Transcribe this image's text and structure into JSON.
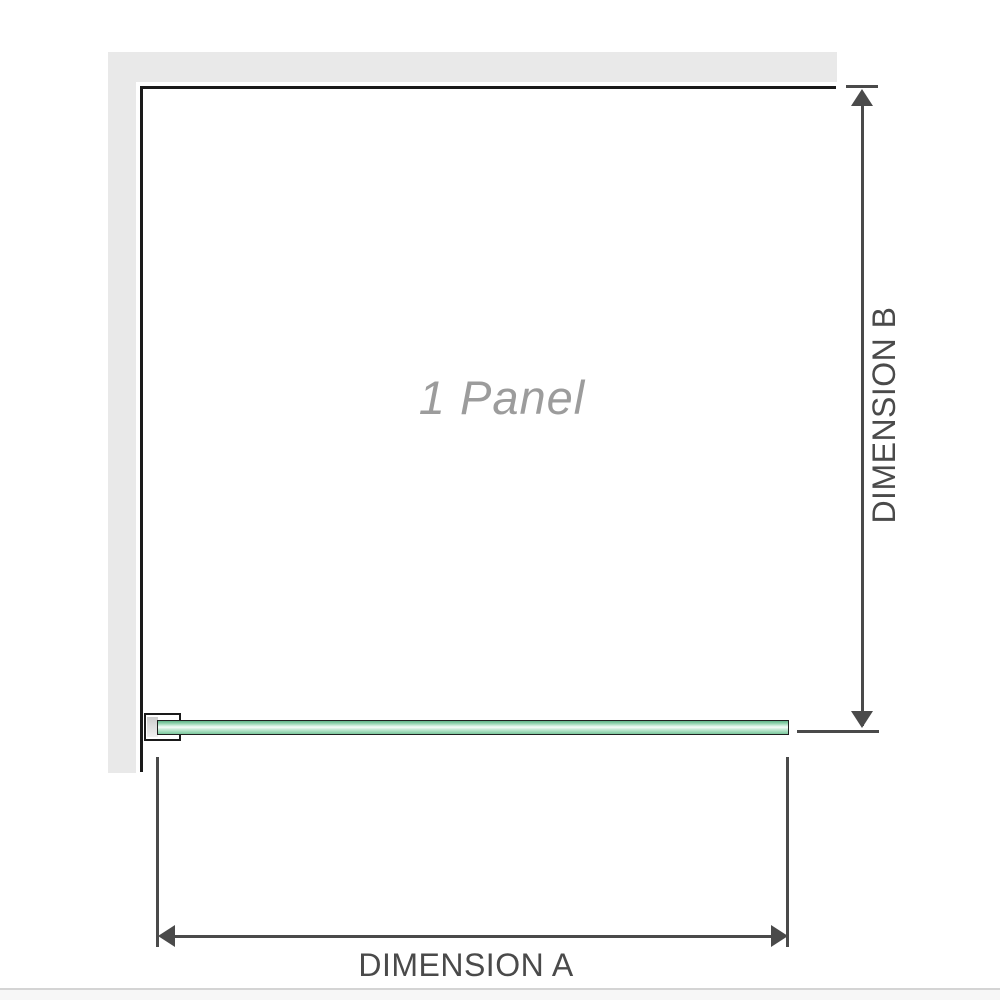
{
  "diagram": {
    "panel_label": "1 Panel",
    "dimension_a": {
      "label": "DIMENSION A",
      "orientation": "horizontal"
    },
    "dimension_b": {
      "label": "DIMENSION B",
      "orientation": "vertical"
    }
  },
  "colors": {
    "wall_gray": "#e9e9e9",
    "outline_black": "#1a1a1a",
    "dim_gray": "#4a4a4a",
    "label_gray": "#9c9c9c",
    "glass_border": "#1f1f1f",
    "glass_green_light": "#ddf3e7",
    "glass_green_dark": "#7cc79c",
    "bracket_fill": "#d6d6d6",
    "divider_gray": "#d4d4d4",
    "footer_strip": "#f7f7f7"
  }
}
